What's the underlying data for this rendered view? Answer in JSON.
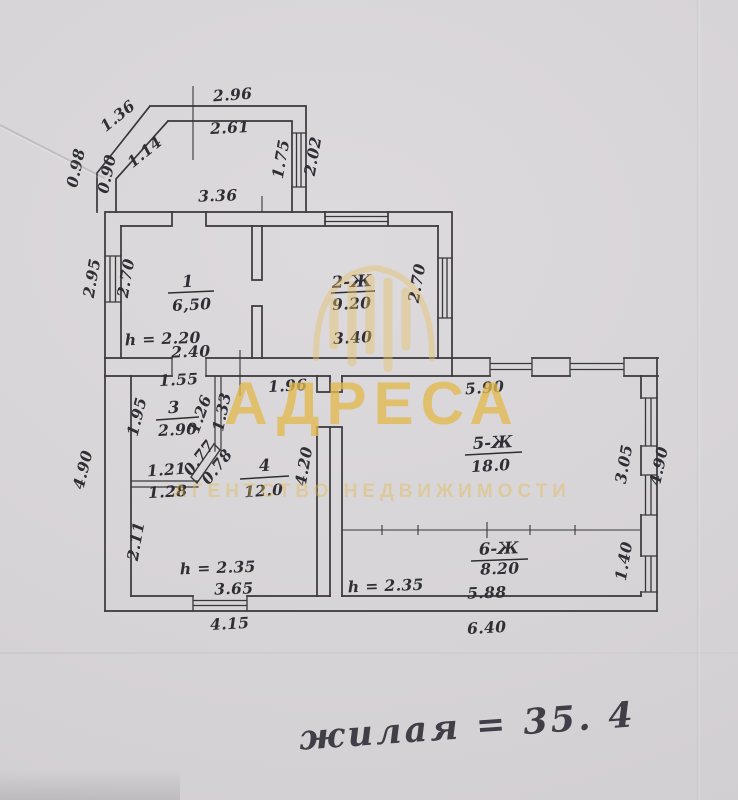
{
  "watermark": {
    "title": "АДРЕСА",
    "subtitle": "АГЕНТСТВО НЕДВИЖИМОСТИ",
    "color": "#e2ba4e",
    "logo": "dome-drip-logo-icon"
  },
  "note": {
    "text": "жилая = 35. 4"
  },
  "rooms": {
    "r1": {
      "number": "1",
      "area": "6,50",
      "height": "h = 2.20"
    },
    "r2": {
      "number": "2-Ж",
      "area": "9.20"
    },
    "r3": {
      "number": "3",
      "area": "2.90"
    },
    "r4": {
      "number": "4",
      "area": "12.0",
      "height": "h = 2.35"
    },
    "r5": {
      "number": "5-Ж",
      "area": "18.0"
    },
    "r6": {
      "number": "6-Ж",
      "area": "8.20",
      "height": "h = 2.35"
    }
  },
  "dims": {
    "porch_top_outer": "2.96",
    "porch_top_inner": "2.61",
    "porch_diag_outer": "1.36",
    "porch_diag_inner": "1.14",
    "porch_left_outer": "0.98",
    "porch_left_inner": "0.90",
    "porch_right_inner": "1.75",
    "porch_right_outer": "2.02",
    "porch_bottom": "3.36",
    "r1_left_outer": "2.95",
    "r1_left_inner": "2.70",
    "r1_bottom": "2.40",
    "r2_right_inner": "2.70",
    "r2_bottom": "3.40",
    "r3_top": "1.55",
    "r4_top": "1.96",
    "r3_left": "1.95",
    "r3_right_a": "1.26",
    "r3_right_b": "1.33",
    "r3_bottom_a": "1.21",
    "r3_bottom_b": "1.28",
    "stove_a": "0.77",
    "stove_b": "0.78",
    "r4_right": "4.20",
    "left_outer": "4.90",
    "r4_left": "2.11",
    "r4_bottom_inner": "3.65",
    "bottom_left_outer": "4.15",
    "r5_top": "5.90",
    "r5_right_inner": "3.05",
    "right_outer": "4.90",
    "r6_right": "1.40",
    "r6_bottom_inner": "5.88",
    "bottom_right_outer": "6.40"
  }
}
